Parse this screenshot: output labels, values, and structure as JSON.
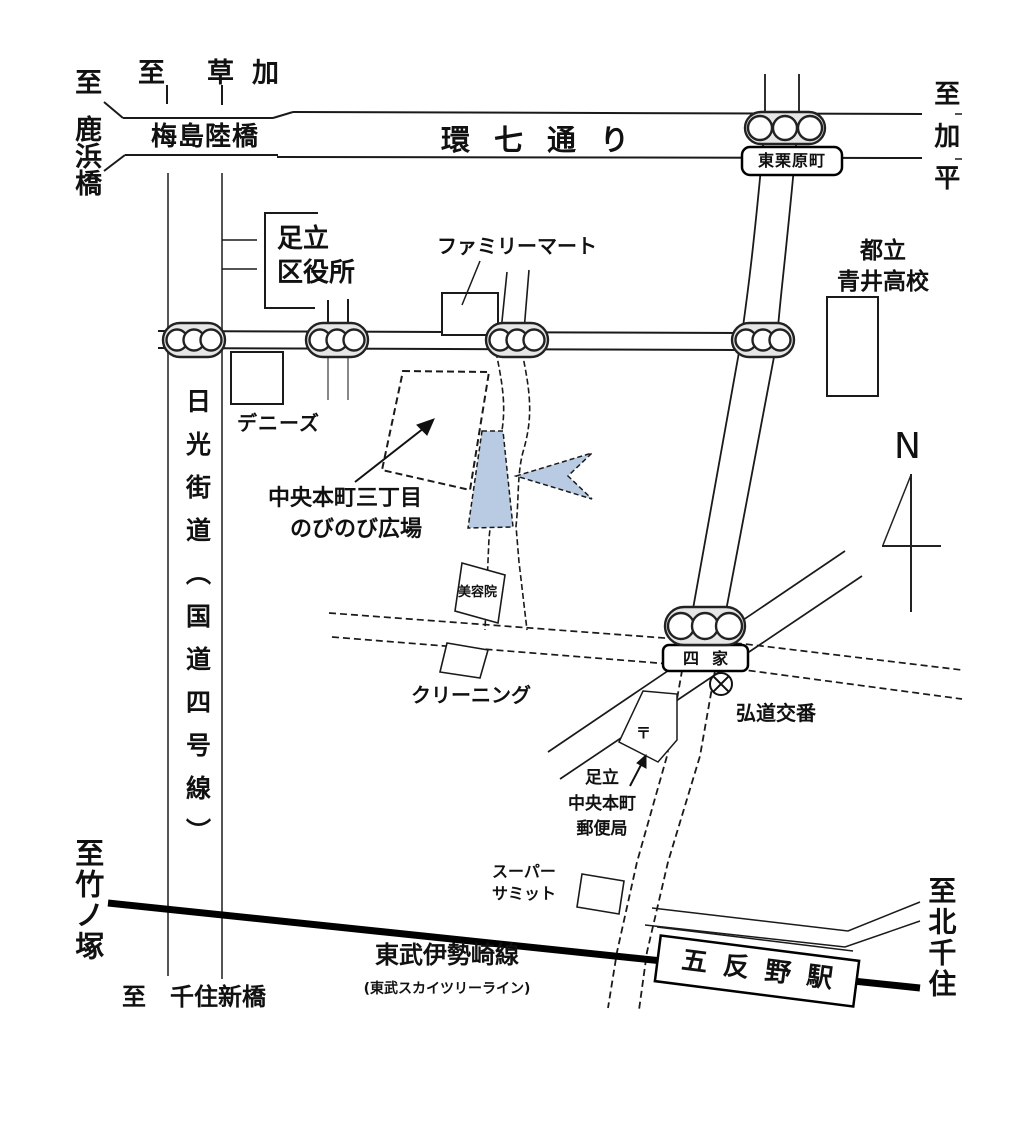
{
  "colors": {
    "accent_blue": "#b9cbe2",
    "ink": "#111111"
  },
  "destinations": {
    "shikahama": {
      "prefix": "至",
      "name": "鹿浜橋"
    },
    "soka": {
      "prefix": "至",
      "name": "草加"
    },
    "kahei": {
      "label": "至加平"
    },
    "takenotsuka": {
      "label": "至竹ノ塚"
    },
    "senju_shinbashi": {
      "prefix": "至",
      "name": "千住新橋"
    },
    "kita_senju": {
      "label": "至北千住"
    }
  },
  "roads": {
    "kannana": {
      "label": "環七通り"
    },
    "nikko": {
      "label": "日光街道（国道四号線）"
    },
    "umejima": {
      "label": "梅島陸橋"
    },
    "railway": {
      "label": "東武伊勢崎線",
      "sub": "(東武スカイツリーライン)"
    },
    "station": {
      "label": "五反野駅"
    }
  },
  "intersections": {
    "higashi_kurihara": {
      "label": "東栗原町"
    },
    "yotsuya": {
      "label": "四家"
    }
  },
  "landmarks": {
    "ward_office": {
      "lines": [
        "足立",
        "区役所"
      ]
    },
    "familymart": {
      "label": "ファミリーマート"
    },
    "aoi_high": {
      "lines": [
        "都立",
        "青井高校"
      ]
    },
    "dennys": {
      "label": "デニーズ"
    },
    "plaza": {
      "lines": [
        "中央本町三丁目",
        "のびのび広場"
      ]
    },
    "beauty_salon": {
      "label": "美容院"
    },
    "cleaning": {
      "label": "クリーニング"
    },
    "koban": {
      "label": "弘道交番"
    },
    "post_office": {
      "lines": [
        "足立",
        "中央本町",
        "郵便局"
      ],
      "mark": "〒"
    },
    "summit": {
      "lines": [
        "スーパー",
        "サミット"
      ]
    }
  },
  "compass": {
    "label": "N"
  }
}
